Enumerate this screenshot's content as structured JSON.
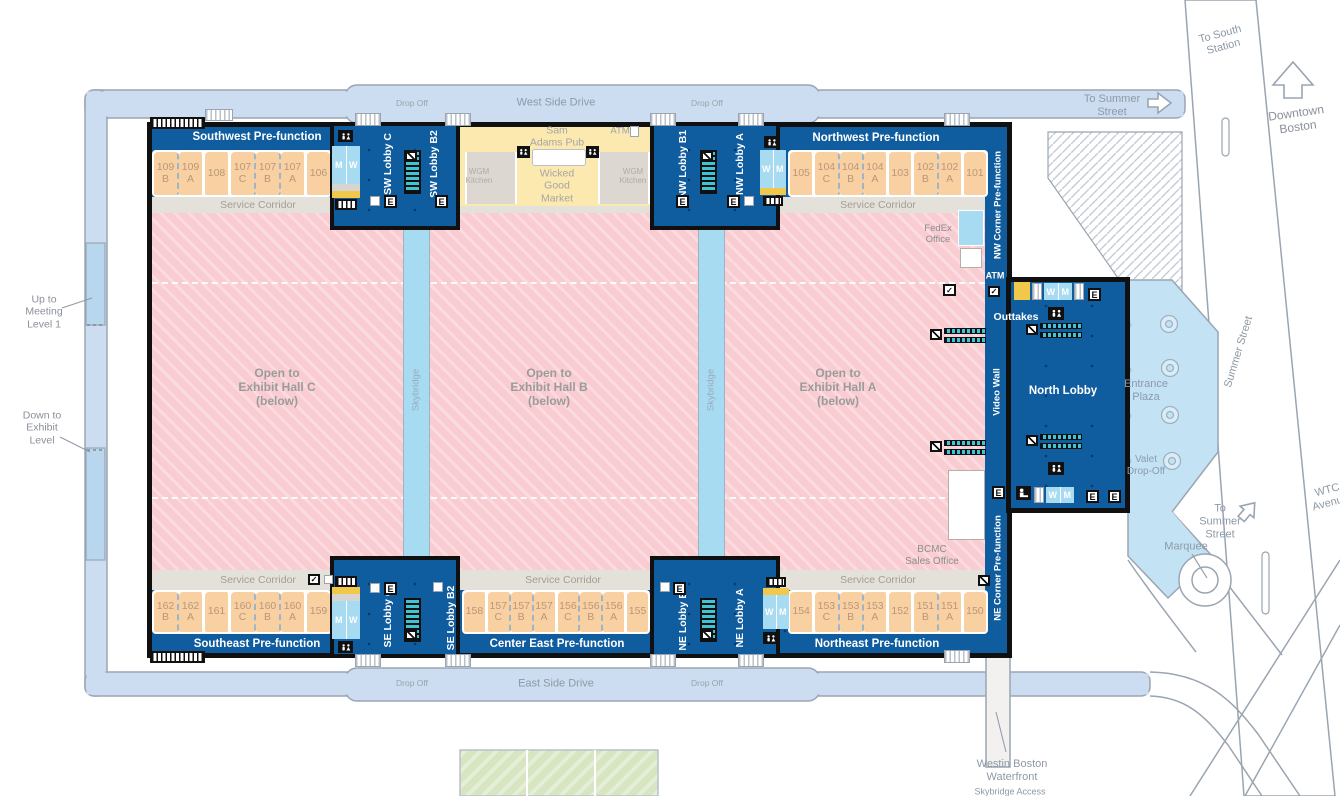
{
  "colors": {
    "building_blue": "#0f5c9f",
    "room_orange": "#f8d0a2",
    "room_text": "#bb9778",
    "exhibit_pink": "#f9ccd1",
    "exhibit_pink_stripe": "#fbdbdf",
    "road_blue": "#ccddf1",
    "road_border": "#9aa5b1",
    "light_blue": "#a6dbf2",
    "plaza_blue": "#c3e2f4",
    "market_yellow": "#fce9b0",
    "kitchen_gray": "#dcd8d1",
    "corridor_gray": "#e4e1da",
    "corridor_text": "#a39d94",
    "lawn_green": "#d7e5c0",
    "escalator_teal": "#3fc4d6",
    "accent_yellow": "#f2c84b",
    "outline_black": "#101010"
  },
  "roads": {
    "west_side_drive": "West Side Drive",
    "east_side_drive": "East Side Drive",
    "drop_off": "Drop Off",
    "to_summer_street": "To Summer\nStreet",
    "to_summer_street_bottom": "To\nSummer\nStreet",
    "to_south_station": "To South\nStation",
    "downtown_boston": "Downtown\nBoston",
    "summer_street": "Summer Street",
    "wtc_avenue": "WTC\nAvenue",
    "marquee": "Marquee",
    "westin": "Westin Boston\nWaterfront",
    "skybridge_access": "Skybridge Access",
    "up_to_meeting": "Up to\nMeeting\nLevel 1",
    "down_to_exhibit": "Down to\nExhibit\nLevel"
  },
  "building": {
    "prefunction": {
      "southwest": "Southwest Pre-function",
      "northwest": "Northwest Pre-function",
      "southeast": "Southeast Pre-function",
      "center_east": "Center East Pre-function",
      "northeast": "Northeast Pre-function",
      "nw_corner": "NW Corner Pre-function",
      "ne_corner": "NE Corner Pre-function"
    },
    "lobbies": {
      "sw_c": "SW Lobby C",
      "sw_b2": "SW Lobby B2",
      "nw_b1": "NW Lobby B1",
      "nw_a": "NW Lobby A",
      "se_c": "SE Lobby C",
      "se_b2": "SE Lobby B2",
      "ne_b1": "NE Lobby B1",
      "ne_a": "NE Lobby A",
      "north": "North Lobby"
    },
    "service_corridor": "Service Corridor",
    "exhibit_halls": {
      "c": "Open to\nExhibit Hall C\n(below)",
      "b": "Open to\nExhibit Hall B\n(below)",
      "a": "Open to\nExhibit Hall A\n(below)"
    },
    "skybridge": "Skybridge",
    "video_wall": "Video Wall",
    "outtakes": "Outtakes",
    "atm": "ATM",
    "fedex_office": "FedEx\nOffice",
    "bcmc_sales_office": "BCMC\nSales Office",
    "sam_adams_pub": "Sam\nAdams Pub",
    "wicked_good_market": "Wicked\nGood\nMarket",
    "wgm_kitchen": "WGM\nKitchen",
    "restroom_m": "M",
    "restroom_w": "W",
    "elevator": "E"
  },
  "plaza": {
    "entrance_plaza": "Entrance\nPlaza",
    "valet": "Valet\nDrop-Off"
  },
  "icons": {
    "check": "✓"
  },
  "rooms": {
    "top_left": [
      {
        "label": "109\nB",
        "cls": "dashed"
      },
      {
        "label": "109\nA",
        "cls": "solid"
      },
      {
        "label": "108",
        "cls": "solid"
      },
      {
        "label": "107\nC",
        "cls": "dashed"
      },
      {
        "label": "107\nB",
        "cls": "dashed"
      },
      {
        "label": "107\nA",
        "cls": "solid"
      },
      {
        "label": "106"
      }
    ],
    "top_right": [
      {
        "label": "105",
        "cls": "solid"
      },
      {
        "label": "104\nC",
        "cls": "dashed"
      },
      {
        "label": "104\nB",
        "cls": "dashed"
      },
      {
        "label": "104\nA",
        "cls": "solid"
      },
      {
        "label": "103",
        "cls": "solid"
      },
      {
        "label": "102\nB",
        "cls": "dashed"
      },
      {
        "label": "102\nA",
        "cls": "solid"
      },
      {
        "label": "101"
      }
    ],
    "bottom_left": [
      {
        "label": "162\nB",
        "cls": "dashed"
      },
      {
        "label": "162\nA",
        "cls": "solid"
      },
      {
        "label": "161",
        "cls": "solid"
      },
      {
        "label": "160\nC",
        "cls": "dashed"
      },
      {
        "label": "160\nB",
        "cls": "dashed"
      },
      {
        "label": "160\nA",
        "cls": "solid"
      },
      {
        "label": "159"
      }
    ],
    "bottom_center": [
      {
        "label": "158",
        "cls": "solid"
      },
      {
        "label": "157\nC",
        "cls": "dashed"
      },
      {
        "label": "157\nB",
        "cls": "dashed"
      },
      {
        "label": "157\nA",
        "cls": "solid"
      },
      {
        "label": "156\nC",
        "cls": "dashed"
      },
      {
        "label": "156\nB",
        "cls": "dashed"
      },
      {
        "label": "156\nA",
        "cls": "solid"
      },
      {
        "label": "155"
      }
    ],
    "bottom_right": [
      {
        "label": "154",
        "cls": "solid"
      },
      {
        "label": "153\nC",
        "cls": "dashed"
      },
      {
        "label": "153\nB",
        "cls": "dashed"
      },
      {
        "label": "153\nA",
        "cls": "solid"
      },
      {
        "label": "152",
        "cls": "solid"
      },
      {
        "label": "151\nB",
        "cls": "dashed"
      },
      {
        "label": "151\nA",
        "cls": "solid"
      },
      {
        "label": "150"
      }
    ]
  }
}
